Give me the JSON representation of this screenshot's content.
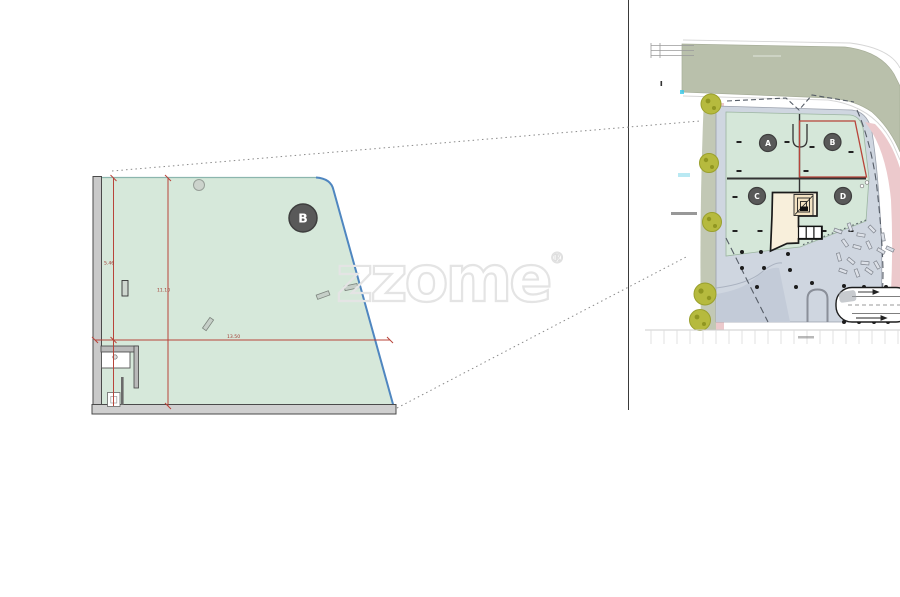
{
  "watermark": {
    "text": "zzome",
    "registered": "®"
  },
  "detail_plan": {
    "plot_label": "B",
    "dim_left_height": "5.46",
    "dim_mid_height": "11.10",
    "dim_width": "13.50"
  },
  "site_plan": {
    "plots": [
      {
        "label": "A"
      },
      {
        "label": "B"
      },
      {
        "label": "C"
      },
      {
        "label": "D"
      }
    ],
    "selected_plot": "B"
  },
  "colors": {
    "plot_green": "#d6e8da",
    "selection_red": "#b8443a",
    "boundary_blue": "#4f86c0",
    "road_olive": "#b9c0ab",
    "sidewalk_pink": "#ecc9cc",
    "paving_gray": "#cfd6e0",
    "building_cream": "#f8efdb",
    "marker_gray": "#595959",
    "tree_green": "#b6ba3e",
    "watermark_gray": "#e4e4e4"
  }
}
